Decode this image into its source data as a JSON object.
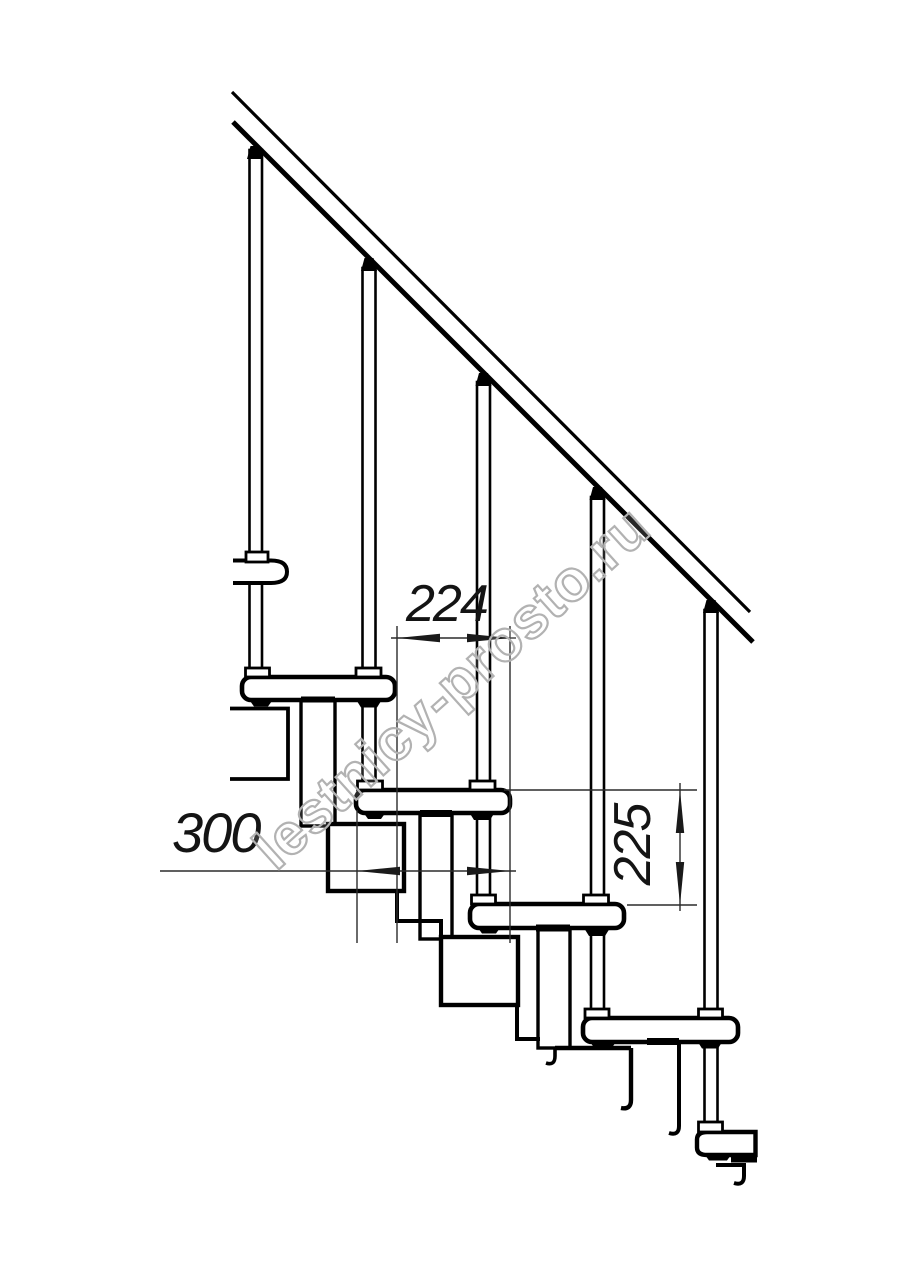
{
  "drawing": {
    "dimensions": {
      "run": {
        "value": "224"
      },
      "width": {
        "value": "300"
      },
      "rise": {
        "value": "225"
      }
    },
    "colors": {
      "line": "#000000",
      "dimension": "#2b2b2b",
      "background": "#ffffff",
      "watermark": "#b2b2b2"
    }
  },
  "watermark": {
    "text": "lestnicy-prosto.ru"
  }
}
